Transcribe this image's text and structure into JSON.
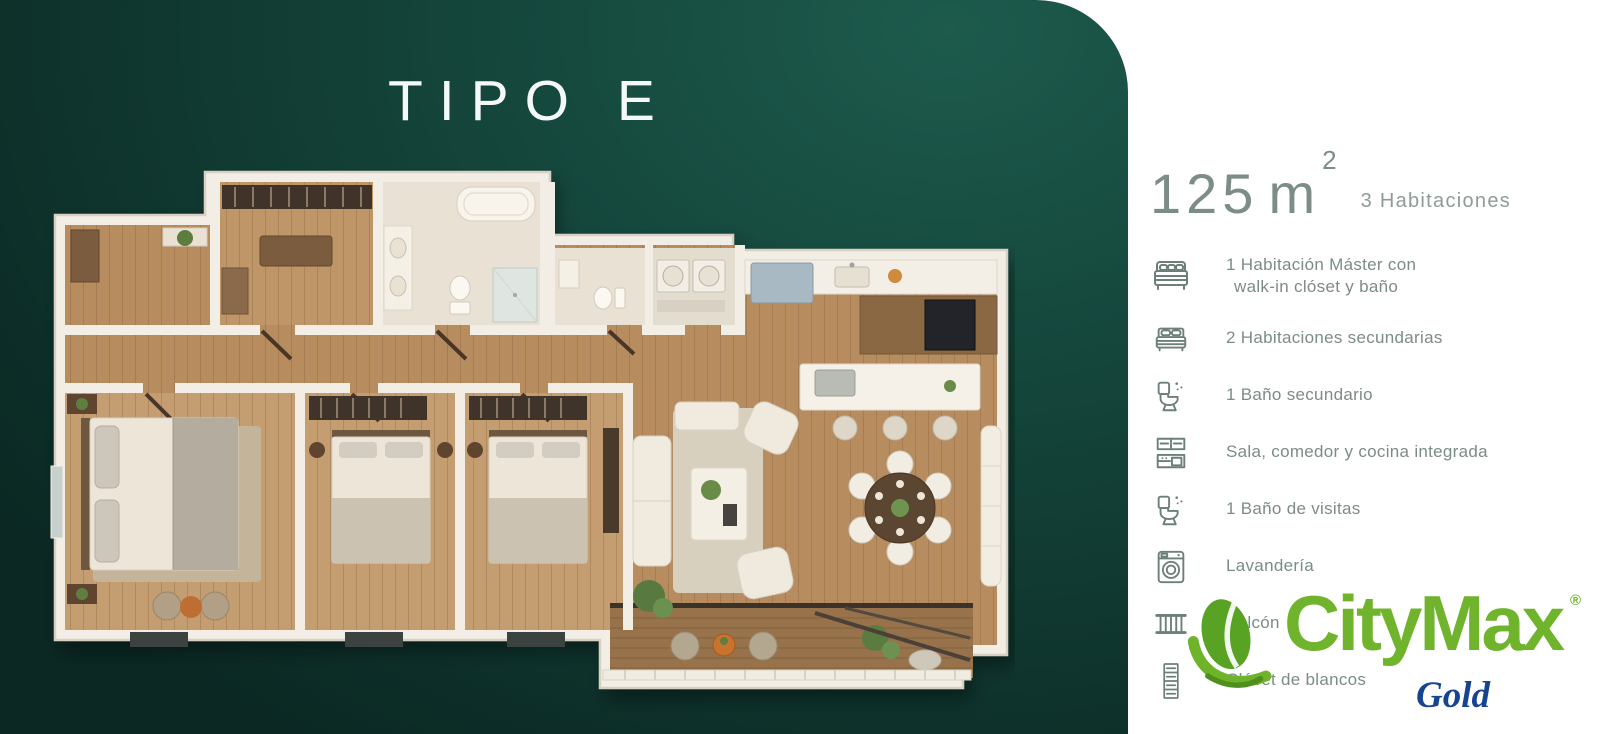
{
  "left_panel": {
    "title": "TIPO E"
  },
  "right_panel": {
    "area_value": "125",
    "area_unit": "m",
    "area_sup": "2",
    "rooms_label": "3 Habitaciones",
    "features": [
      {
        "icon": "master-bed",
        "lines": [
          "1 Habitación Máster con",
          "walk-in clóset y baño"
        ]
      },
      {
        "icon": "bed",
        "lines": [
          "2 Habitaciones secundarias"
        ]
      },
      {
        "icon": "toilet",
        "lines": [
          "1 Baño secundario"
        ]
      },
      {
        "icon": "kitchen",
        "lines": [
          "Sala, comedor y cocina integrada"
        ]
      },
      {
        "icon": "toilet",
        "lines": [
          "1 Baño de visitas"
        ]
      },
      {
        "icon": "washer",
        "lines": [
          "Lavandería"
        ]
      },
      {
        "icon": "balcony",
        "lines": [
          "Balcón"
        ]
      },
      {
        "icon": "linen-closet",
        "lines": [
          "Clóset de blancos"
        ]
      }
    ]
  },
  "logo": {
    "brand": "CityMax",
    "registered": "®",
    "sub": "Gold"
  },
  "colors": {
    "panel_green_dark": "#0b2823",
    "panel_green_light": "#1d5b4d",
    "brand_green": "#6fb42c",
    "gold_blue": "#16458f",
    "feature_text": "#7b8c86",
    "area_text": "#7c8d87"
  }
}
